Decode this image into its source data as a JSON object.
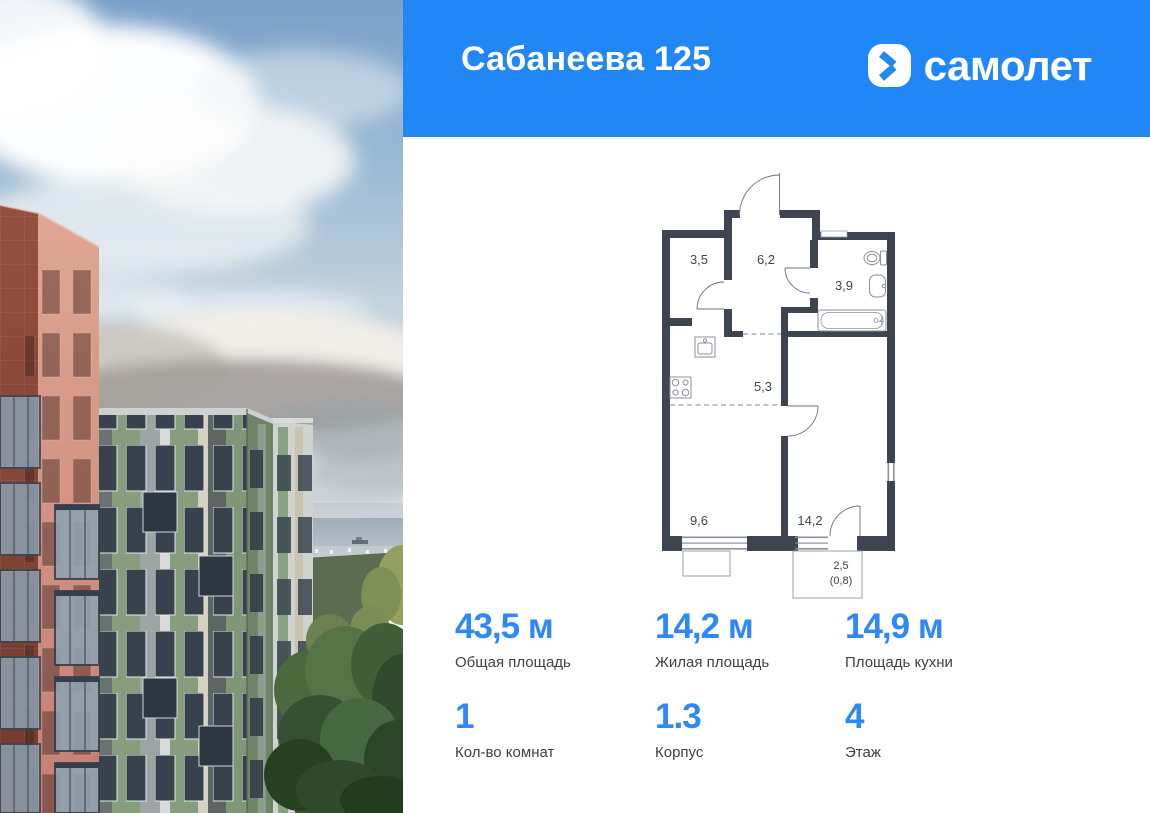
{
  "header": {
    "title": "Сабанеева 125",
    "brand": "самолет",
    "bg_color": "#2187f6"
  },
  "photo": {
    "description": "Terracotta and green residential high-rise towers above a forested hill by the sea, cloudy sky"
  },
  "floor_plan": {
    "rooms": [
      {
        "name": "wardrobe",
        "area": "3,5"
      },
      {
        "name": "entrance-hall",
        "area": "6,2"
      },
      {
        "name": "bathroom",
        "area": "3,9"
      },
      {
        "name": "kitchen-niche",
        "area": "5,3"
      },
      {
        "name": "bedroom",
        "area": "9,6"
      },
      {
        "name": "living-room",
        "area": "14,2"
      },
      {
        "name": "balcony",
        "area": "2,5",
        "area_reduced": "(0,8)"
      }
    ]
  },
  "stats": {
    "row1": [
      {
        "value": "43,5 м",
        "label": "Общая площадь"
      },
      {
        "value": "14,2 м",
        "label": "Жилая площадь"
      },
      {
        "value": "14,9 м",
        "label": "Площадь кухни"
      }
    ],
    "row2": [
      {
        "value": "1",
        "label": "Кол-во комнат"
      },
      {
        "value": "1.3",
        "label": "Корпус"
      },
      {
        "value": "4",
        "label": "Этаж"
      }
    ]
  },
  "colors": {
    "accent": "#2187f6",
    "stat_number": "#2e88f6",
    "wall": "#3e4450"
  }
}
